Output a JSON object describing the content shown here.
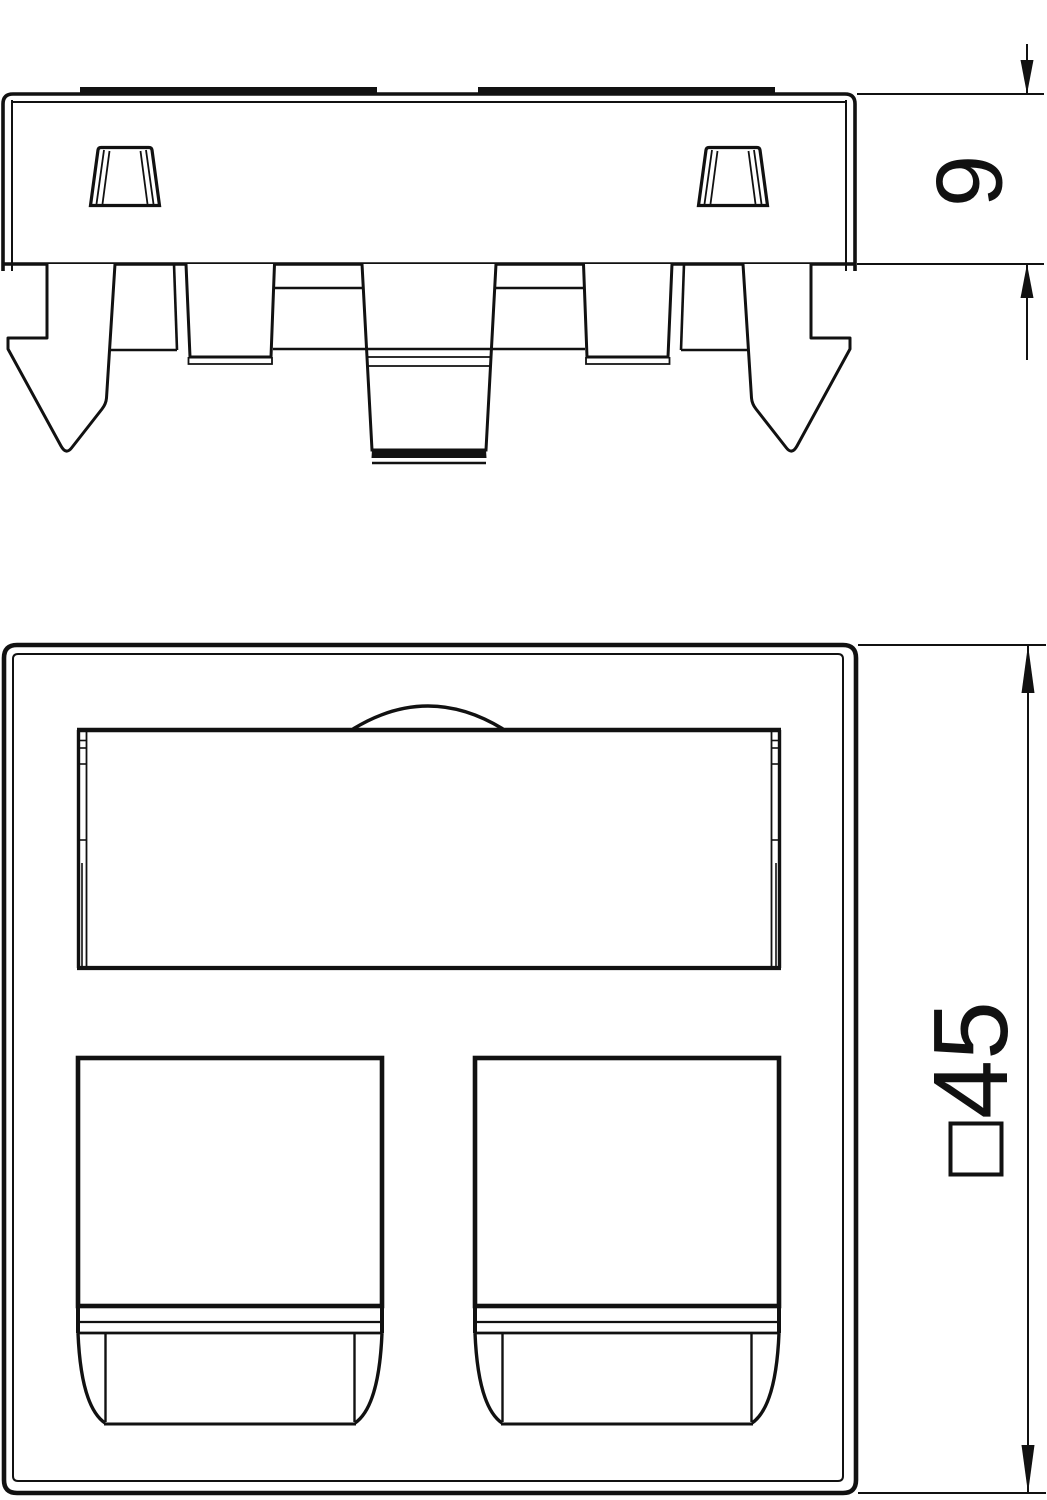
{
  "canvas": {
    "background_color": "#ffffff",
    "line_color": "#111111"
  },
  "side_view": {
    "dimension": {
      "label": "9"
    }
  },
  "front_view": {
    "dimension": {
      "label": "45",
      "symbol": "square"
    }
  }
}
